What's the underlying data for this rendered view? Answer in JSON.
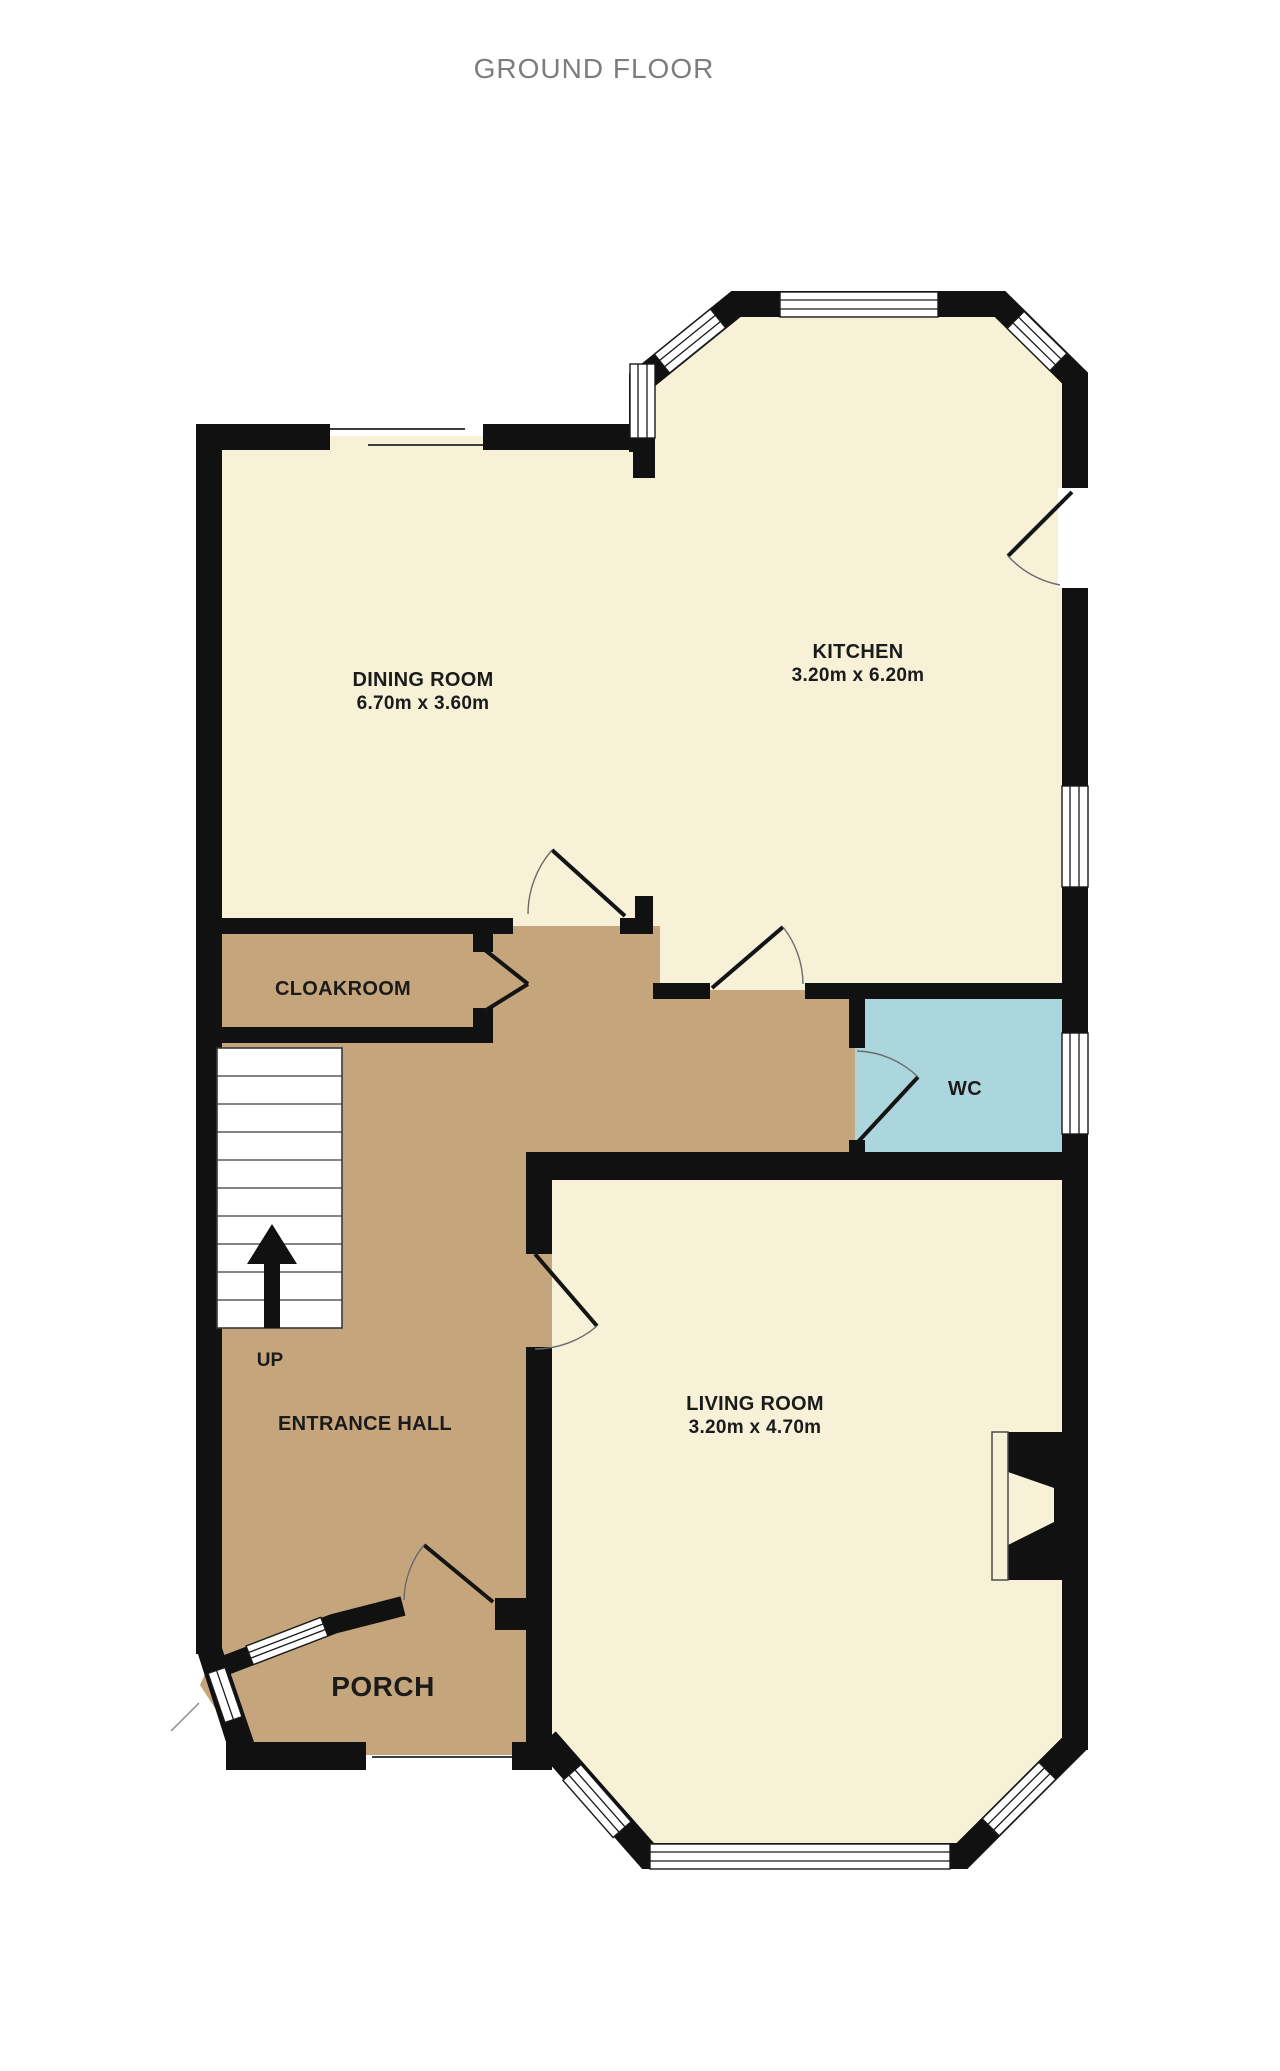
{
  "title": "GROUND FLOOR",
  "floorplan": {
    "colors": {
      "room": "#f6f1d7",
      "hall": "#c5a67c",
      "wc": "#abd6dd",
      "wall": "#111111",
      "window": "#ffffff"
    },
    "rooms": [
      {
        "id": "dining-room",
        "name": "DINING ROOM",
        "dimensions": "6.70m  x 3.60m"
      },
      {
        "id": "kitchen",
        "name": "KITCHEN",
        "dimensions": "3.20m  x 6.20m"
      },
      {
        "id": "cloakroom",
        "name": "CLOAKROOM",
        "dimensions": ""
      },
      {
        "id": "wc",
        "name": "WC",
        "dimensions": ""
      },
      {
        "id": "entrance-hall",
        "name": "ENTRANCE HALL",
        "dimensions": ""
      },
      {
        "id": "living-room",
        "name": "LIVING ROOM",
        "dimensions": "3.20m  x 4.70m"
      },
      {
        "id": "porch",
        "name": "PORCH",
        "dimensions": ""
      }
    ],
    "stairs": {
      "label": "UP"
    }
  }
}
